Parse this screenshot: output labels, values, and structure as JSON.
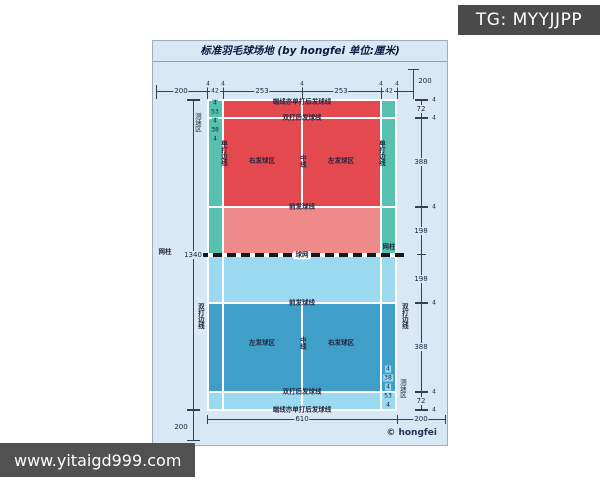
{
  "watermarks": {
    "tg_badge": "TG: MYYJJPP",
    "website": "www.yitaigd999.com"
  },
  "colors": {
    "panel_bg": "#d9e8f5",
    "red": "#e4494f",
    "salmon": "#ee8a8a",
    "teal": "#57c1b0",
    "light_blue": "#9ad9f0",
    "medium_blue": "#3f9fc8",
    "badge_bg": "#4a4a4a",
    "site_bg": "#515151"
  },
  "diagram": {
    "title": "标准羽毛球场地 (by hongfei 单位:厘米)",
    "copyright": "© hongfei",
    "court_lines": {
      "top_endline": "端线亦单打后发球线",
      "top_doubles_long_service": "双打后发球线",
      "top_short_service": "前发球线",
      "net": "球网",
      "net_post_left": "网柱",
      "net_post_right": "网柱",
      "bottom_short_service": "前发球线",
      "bottom_doubles_long_service": "双打后发球线",
      "bottom_endline": "端线亦单打后发球线"
    },
    "regions": {
      "upper_left": "右发球区",
      "upper_right": "左发球区",
      "lower_left": "左发球区",
      "lower_right": "右发球区",
      "center_upper": "中线",
      "center_lower": "中线",
      "singles_left": "单打边线",
      "singles_right": "单打边线",
      "doubles_left": "双打边线",
      "doubles_right": "双打边线",
      "speed_top": "测速区",
      "speed_bottom": "测速区"
    },
    "dims": {
      "top": [
        "200",
        "4",
        "42",
        "4",
        "253",
        "4",
        "253",
        "4",
        "42",
        "4"
      ],
      "top_right": "200",
      "right": [
        "4",
        "72",
        "4",
        "388",
        "4",
        "198",
        "198",
        "4",
        "388",
        "4",
        "72",
        "4"
      ],
      "left_total": "1340",
      "bottom_width": "610",
      "bottom_margin": "200",
      "bottom_left": "200",
      "speed_top": [
        "4",
        "53",
        "4",
        "38",
        "4"
      ],
      "speed_bottom": [
        "4",
        "38",
        "4",
        "53",
        "4"
      ]
    }
  }
}
